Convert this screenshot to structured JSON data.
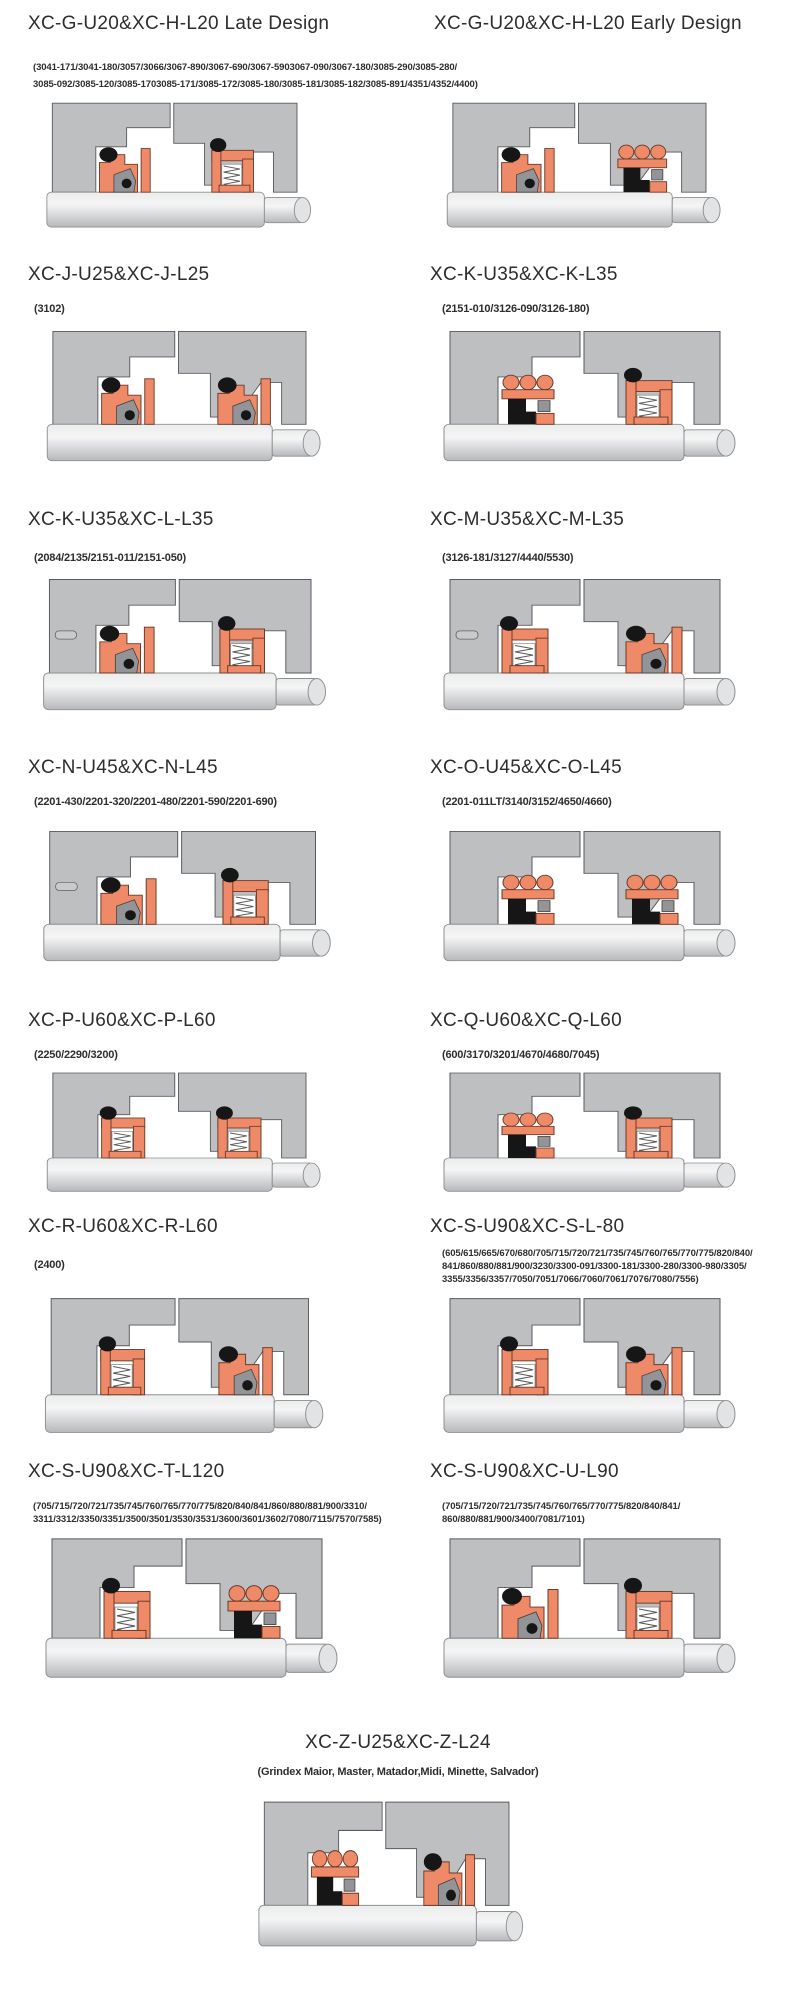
{
  "sections": {
    "g_late": {
      "title": "XC-G-U20&XC-H-L20 Late Design"
    },
    "g_early": {
      "title": "XC-G-U20&XC-H-L20 Early Design"
    },
    "g_shared_parts": {
      "line1": "(3041-171/3041-180/3057/3066/3067-890/3067-690/3067-5903067-090/3067-180/3085-290/3085-280/",
      "line2": "3085-092/3085-120/3085-1703085-171/3085-172/3085-180/3085-181/3085-182/3085-891/4351/4352/4400)"
    },
    "j": {
      "title": "XC-J-U25&XC-J-L25",
      "parts_line1": "(3102)"
    },
    "k": {
      "title": "XC-K-U35&XC-K-L35",
      "parts_line1": "(2151-010/3126-090/3126-180)"
    },
    "kl": {
      "title": "XC-K-U35&XC-L-L35",
      "parts_line1": "(2084/2135/2151-011/2151-050)"
    },
    "m": {
      "title": "XC-M-U35&XC-M-L35",
      "parts_line1": "(3126-181/3127/4440/5530)"
    },
    "n": {
      "title": "XC-N-U45&XC-N-L45",
      "parts_line1": "(2201-430/2201-320/2201-480/2201-590/2201-690)"
    },
    "o": {
      "title": "XC-O-U45&XC-O-L45",
      "parts_line1": "(2201-011LT/3140/3152/4650/4660)"
    },
    "p": {
      "title": "XC-P-U60&XC-P-L60",
      "parts_line1": "(2250/2290/3200)"
    },
    "q": {
      "title": "XC-Q-U60&XC-Q-L60",
      "parts_line1": "(600/3170/3201/4670/4680/7045)"
    },
    "r": {
      "title": "XC-R-U60&XC-R-L60",
      "parts_line1": "(2400)"
    },
    "s_l80": {
      "title": "XC-S-U90&XC-S-L-80",
      "parts_line1": "(605/615/665/670/680/705/715/720/721/735/745/760/765/770/775/820/840/",
      "parts_line2": "841/860/880/881/900/3230/3300-091/3300-181/3300-280/3300-980/3305/",
      "parts_line3": "3355/3356/3357/7050/7051/7066/7060/7061/7076/7080/7556)"
    },
    "t": {
      "title": "XC-S-U90&XC-T-L120",
      "parts_line1": "(705/715/720/721/735/745/760/765/770/775/820/840/841/860/880/881/900/3310/",
      "parts_line2": "3311/3312/3350/3351/3500/3501/3530/3531/3600/3601/3602/7080/7115/7570/7585)"
    },
    "u": {
      "title": "XC-S-U90&XC-U-L90",
      "parts_line1": "(705/715/720/721/735/745/760/765/770/775/820/840/841/",
      "parts_line2": "860/880/881/900/3400/7081/7101)"
    },
    "z": {
      "title": "XC-Z-U25&XC-Z-L24",
      "parts_line1": "(Grindex  Maior, Master, Matador,Midi, Minette, Salvador)"
    }
  },
  "diagram_colors": {
    "housing_gray": "#bdbfc1",
    "housing_outline": "#595a5e",
    "seal_orange": "#ef8a68",
    "seal_outline": "#6b3a28",
    "elastomer_black": "#161616",
    "hardware_gray": "#929497",
    "shaft_light": "#ebecec",
    "shaft_dark": "#b6b8ba",
    "shaft_outline": "#8d8f92"
  }
}
